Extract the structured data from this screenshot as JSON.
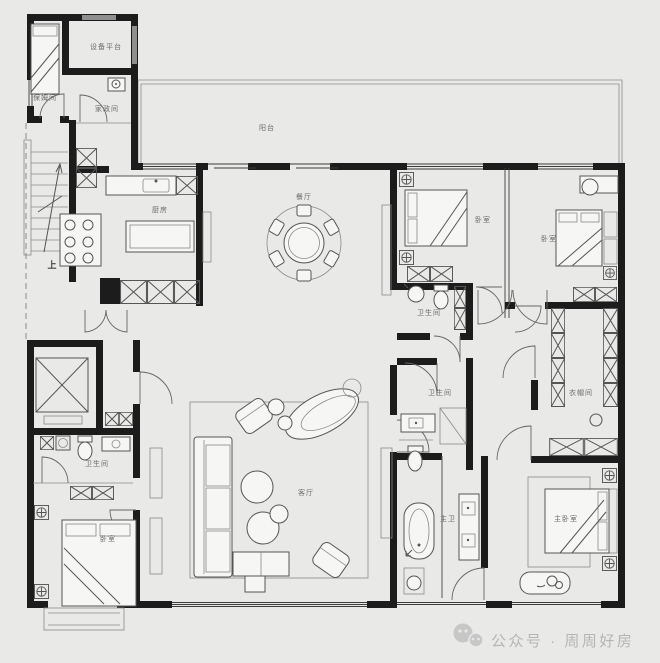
{
  "plan": {
    "type": "apartment-floor-plan",
    "colors": {
      "background": "#e9e9e7",
      "wall": "#1c1c1c",
      "line": "#555555",
      "label": "#6a6a6a",
      "watermark": "#b5b5b5"
    },
    "rooms": {
      "equipment_platform": "设备平台",
      "nanny_room": "保姆间",
      "housekeeping_room": "家政间",
      "balcony": "阳台",
      "kitchen": "厨房",
      "dining_room": "餐厅",
      "bedroom_top_mid": "卧室",
      "bedroom_top_right": "卧室",
      "bathroom_top": "卫生间",
      "closet": "衣帽间",
      "bathroom_mid": "卫生间",
      "master_bath": "主卫",
      "master_bedroom": "主卧室",
      "living_room": "客厅",
      "bathroom_left": "卫生间",
      "bedroom_left": "卧室",
      "stairs_up": "上"
    },
    "watermark": {
      "icon": "wechat-icon",
      "label": "公众号 · 周周好房"
    }
  }
}
